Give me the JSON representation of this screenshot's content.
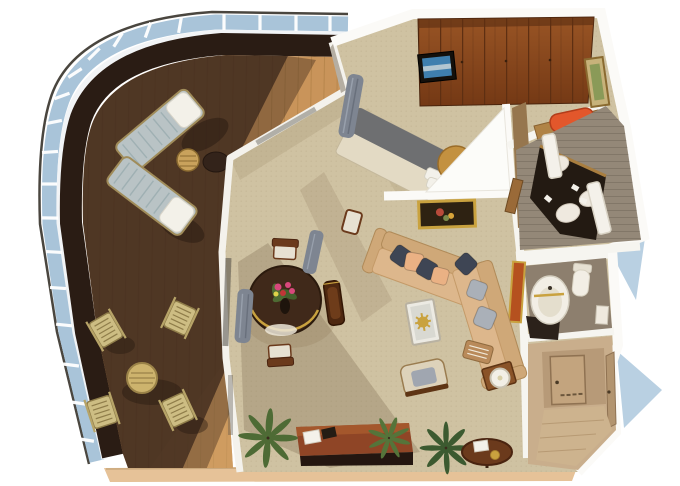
{
  "title": "3D cutaway floor plan rendering of a suite with curved wraparound balcony",
  "palette": {
    "background": "#ffffff",
    "deck_wood": "#c9945a",
    "deck_wood_line": "#a87a40",
    "deck_shadow": "#352218",
    "deck_edge_band": "#2a1c14",
    "railing_glass": "#a9c4d9",
    "outer_line": "#4a463f",
    "wall_white": "#fbfaf7",
    "carpet": "#cfc2a2",
    "wardrobe_wood_light": "#a05a28",
    "wardrobe_wood_dark": "#6e3412",
    "bed_runner_gray": "#6e6f71",
    "bedding": "#e3dac4",
    "headboard_gold": "#c39140",
    "sofa_tan": "#ddb78c",
    "sofa_tan_dark": "#cfa878",
    "pillow_navy": "#3e4554",
    "pillow_peach": "#eab184",
    "pillow_gray": "#aab0b8",
    "dining_table_wood": "#40291a",
    "chair_wood": "#6b3a1c",
    "vanity_dark": "#231a12",
    "bath_tile": "#948878",
    "stool_orange": "#e2572b",
    "entry_wall": "#c9ae8c",
    "curtain_gray": "#7e8591",
    "plant_green": "#4e6b35",
    "accent_gold": "#c9a23f",
    "slab_edge": "#e6c298",
    "tv_screen_blue": "#3f7fae",
    "water_blue": "#b9d0e2",
    "artwork_orange": "#b5511f"
  },
  "scene": {
    "type": "floor-plan-3d-render",
    "view": "isometric-cutaway",
    "rooms": [
      {
        "name": "Wraparound balcony",
        "furniture": [
          "2 sun loungers with white cushions",
          "round teak side table",
          "dark round table",
          "4 folding deck chairs",
          "round deck table",
          "teak plank decking",
          "curved glass railing"
        ]
      },
      {
        "name": "Bedroom",
        "furniture": [
          "double bed with gray runner",
          "white pillows",
          "round gold headboard",
          "full-width wood wardrobe",
          "wall-mounted TV",
          "gray curtain"
        ]
      },
      {
        "name": "Dressing area",
        "furniture": [
          "vanity desk",
          "orange bench",
          "framed art"
        ]
      },
      {
        "name": "Master bathroom",
        "furniture": [
          "dark double-basin vanity",
          "two white columns",
          "round white basins",
          "toiletries"
        ]
      },
      {
        "name": "Guest bathroom",
        "furniture": [
          "pedestal sink with gold faucet",
          "toilet",
          "storage shelf",
          "dark vanity base"
        ]
      },
      {
        "name": "Living room",
        "furniture": [
          "L-shaped sectional sofa",
          "navy and peach pillows",
          "glass coffee table with gold starfish",
          "armchair",
          "side table with lamp",
          "console desk",
          "round side table with notepad",
          "potted palms",
          "framed still-life painting",
          "orange wall artwork",
          "antique wood chair"
        ]
      },
      {
        "name": "Dining area",
        "furniture": [
          "round dark-wood dining table",
          "flower centerpiece",
          "wood chairs with white seats",
          "gray curtains"
        ]
      },
      {
        "name": "Entry corridor",
        "furniture": [
          "cabin door",
          "closet door"
        ]
      }
    ]
  }
}
